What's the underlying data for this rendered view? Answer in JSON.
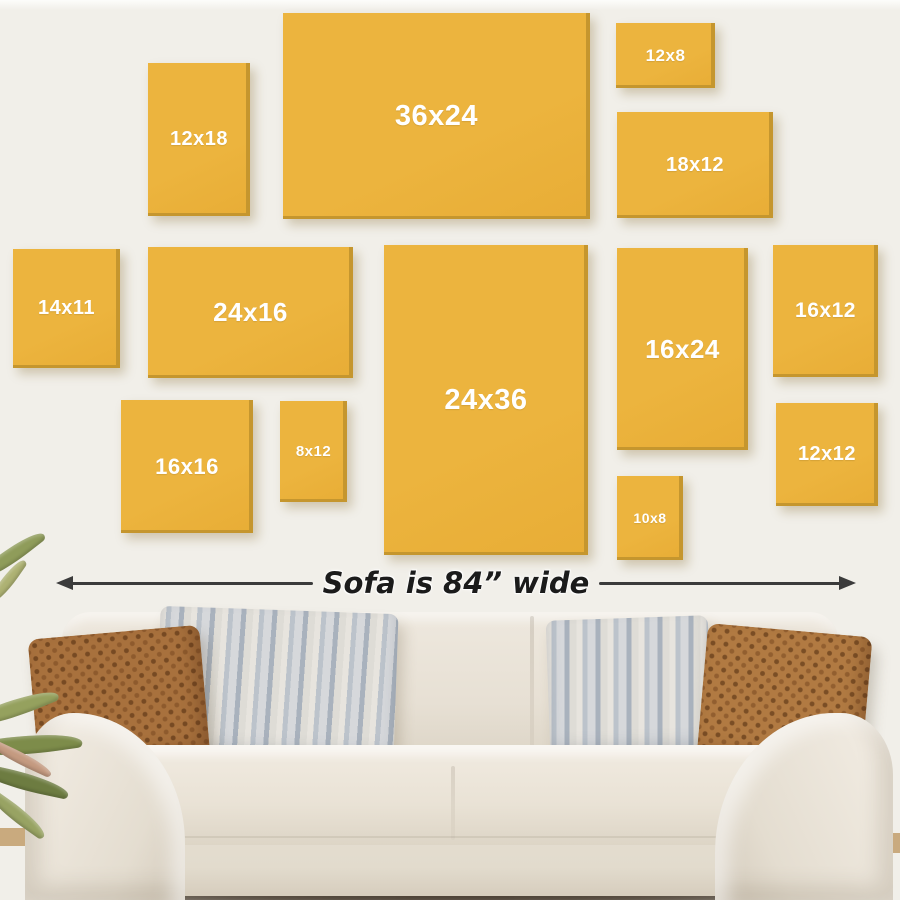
{
  "scene": {
    "description": "Canvas print size guide on wall above sofa",
    "wall_color": "#f1efe9",
    "top_strip_color": "#fdfdfb"
  },
  "frames": {
    "fill": "#ecb43e",
    "edge_shade": "#c5962e",
    "label_color": "#ffffff",
    "items": [
      {
        "label": "12x18",
        "x": 148,
        "y": 63,
        "w": 102,
        "h": 153,
        "fs": 20
      },
      {
        "label": "36x24",
        "x": 283,
        "y": 13,
        "w": 307,
        "h": 206,
        "fs": 29
      },
      {
        "label": "12x8",
        "x": 616,
        "y": 23,
        "w": 99,
        "h": 65,
        "fs": 17
      },
      {
        "label": "18x12",
        "x": 617,
        "y": 112,
        "w": 156,
        "h": 106,
        "fs": 20
      },
      {
        "label": "14x11",
        "x": 13,
        "y": 249,
        "w": 107,
        "h": 119,
        "fs": 20
      },
      {
        "label": "24x16",
        "x": 148,
        "y": 247,
        "w": 205,
        "h": 131,
        "fs": 26
      },
      {
        "label": "24x36",
        "x": 384,
        "y": 245,
        "w": 204,
        "h": 310,
        "fs": 29
      },
      {
        "label": "16x24",
        "x": 617,
        "y": 248,
        "w": 131,
        "h": 202,
        "fs": 26
      },
      {
        "label": "16x12",
        "x": 773,
        "y": 245,
        "w": 105,
        "h": 132,
        "fs": 21
      },
      {
        "label": "16x16",
        "x": 121,
        "y": 400,
        "w": 132,
        "h": 133,
        "fs": 22
      },
      {
        "label": "8x12",
        "x": 280,
        "y": 401,
        "w": 67,
        "h": 101,
        "fs": 15
      },
      {
        "label": "12x12",
        "x": 776,
        "y": 403,
        "w": 102,
        "h": 103,
        "fs": 20
      },
      {
        "label": "10x8",
        "x": 617,
        "y": 476,
        "w": 66,
        "h": 84,
        "fs": 14
      }
    ]
  },
  "size_guide": {
    "label": "Sofa is 84” wide",
    "arrow_color": "#3b3b3b",
    "text_color": "#1b1b1b"
  },
  "sofa": {
    "fabric_color": "#e8e2d7",
    "fabric_shadow": "#d3cabb",
    "fabric_highlight": "#f1ebe1",
    "floor_shadow_color": "#35291c",
    "pillow_rust_left_color": "#a8713d",
    "pillow_rust_right_color": "#b17a42",
    "pillow_gray_light": "#e7e4de",
    "pillow_gray_dark": "#a9b2bd"
  },
  "floor": {
    "color": "#c9aa7e"
  },
  "plant": {
    "leaves": [
      {
        "x": -28,
        "y": 548,
        "w": 78,
        "h": 16,
        "rot": -38,
        "color": "#8f9c5a"
      },
      {
        "x": -18,
        "y": 575,
        "w": 52,
        "h": 12,
        "rot": -55,
        "color": "#aeb273"
      },
      {
        "x": -35,
        "y": 700,
        "w": 95,
        "h": 18,
        "rot": -22,
        "color": "#95a15e"
      },
      {
        "x": -30,
        "y": 735,
        "w": 112,
        "h": 20,
        "rot": -8,
        "color": "#7d8c4a"
      },
      {
        "x": -25,
        "y": 772,
        "w": 95,
        "h": 18,
        "rot": 12,
        "color": "#6d7c41"
      },
      {
        "x": -15,
        "y": 752,
        "w": 70,
        "h": 12,
        "rot": 25,
        "color": "#c49a80"
      },
      {
        "x": -20,
        "y": 806,
        "w": 72,
        "h": 15,
        "rot": 35,
        "color": "#98a363"
      }
    ]
  }
}
